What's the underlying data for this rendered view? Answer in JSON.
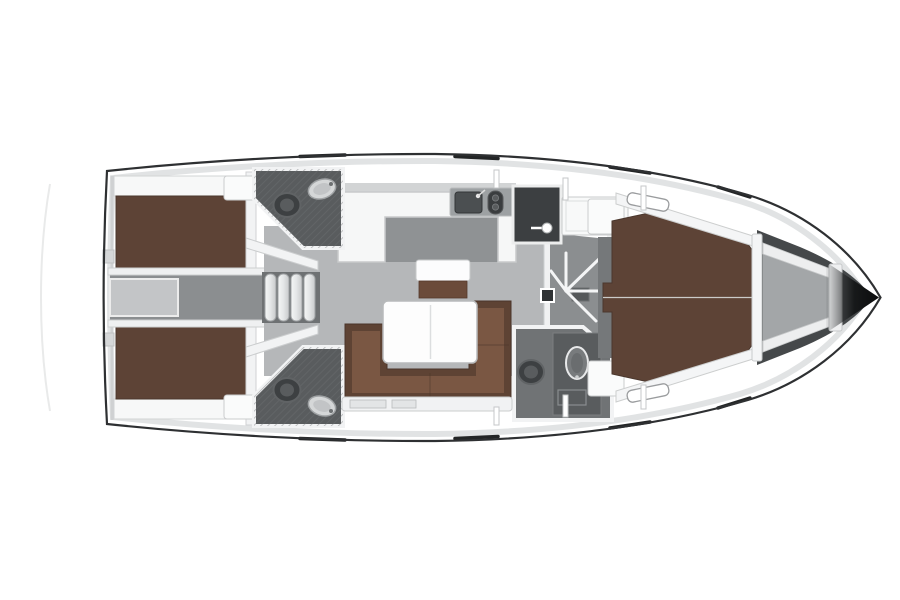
{
  "diagram": {
    "type": "sailing-yacht-interior-floor-plan",
    "view": "top-down",
    "orientation": {
      "bow": "right",
      "stern": "left"
    }
  },
  "layout_counts": {
    "cabins": 3,
    "heads": 3,
    "double_berths": 2,
    "v_berths": 1,
    "companionway_steps": 4,
    "toilets": 3,
    "washbasins": 3
  },
  "rooms": [
    {
      "id": "aft-cabin-port",
      "name": "aft double cabin (top)"
    },
    {
      "id": "aft-cabin-starboard",
      "name": "aft double cabin (bottom)"
    },
    {
      "id": "aft-corridor",
      "name": "engine / companionway corridor"
    },
    {
      "id": "aft-head-port",
      "name": "aft head (top)"
    },
    {
      "id": "aft-head-starboard",
      "name": "aft head (bottom)"
    },
    {
      "id": "saloon",
      "name": "saloon with U-sofa and table"
    },
    {
      "id": "galley",
      "name": "L-shaped galley with sink and stove"
    },
    {
      "id": "midship-corridor",
      "name": "corridor with cabin door"
    },
    {
      "id": "wardrobe",
      "name": "wardrobe locker"
    },
    {
      "id": "forward-head",
      "name": "forward head"
    },
    {
      "id": "forward-cabin",
      "name": "forward V-berth cabin"
    },
    {
      "id": "anchor-locker",
      "name": "bow anchor locker"
    }
  ],
  "colors": {
    "background": "#ffffff",
    "hull_outline": "#2e3032",
    "deck_white": "#ffffff",
    "wall_white": "#f2f3f4",
    "shading_gray": "#dadcdd",
    "transom_arc": "#e9eaea",
    "berth_brown": "#5d4336",
    "sofa_brown": "#5e4334",
    "sofa_brown_light": "#7a5743",
    "bench_brown": "#6b4b3a",
    "table_white": "#fdfdfd",
    "saloon_floor": "#b5b7b9",
    "galley_floor": "#8f9294",
    "galley_counter": "#f6f7f7",
    "sink_counter": "#9da1a3",
    "basin_dark": "#4b4f51",
    "appliance_dark": "#3a3d3f",
    "corridor_floor": "#8b8e90",
    "steps_floor": "#6e7173",
    "head_floor": "#595c5e",
    "toilet_dark": "#3d4042",
    "sink_white": "#d5d7d8",
    "wardrobe_dark": "#3c3f41",
    "fwd_head_floor": "#707375",
    "vanity_dark": "#595c5e",
    "fwd_floor_strip": "#75787a",
    "anchor_locker": "#a3a6a8",
    "bow_dark": "#45484a",
    "engine_hatch": "#c3c5c7",
    "nightstand_white": "#fafbfb",
    "bulkhead_white": "#f4f5f6",
    "sofa_trim": "#f1f2f3"
  }
}
